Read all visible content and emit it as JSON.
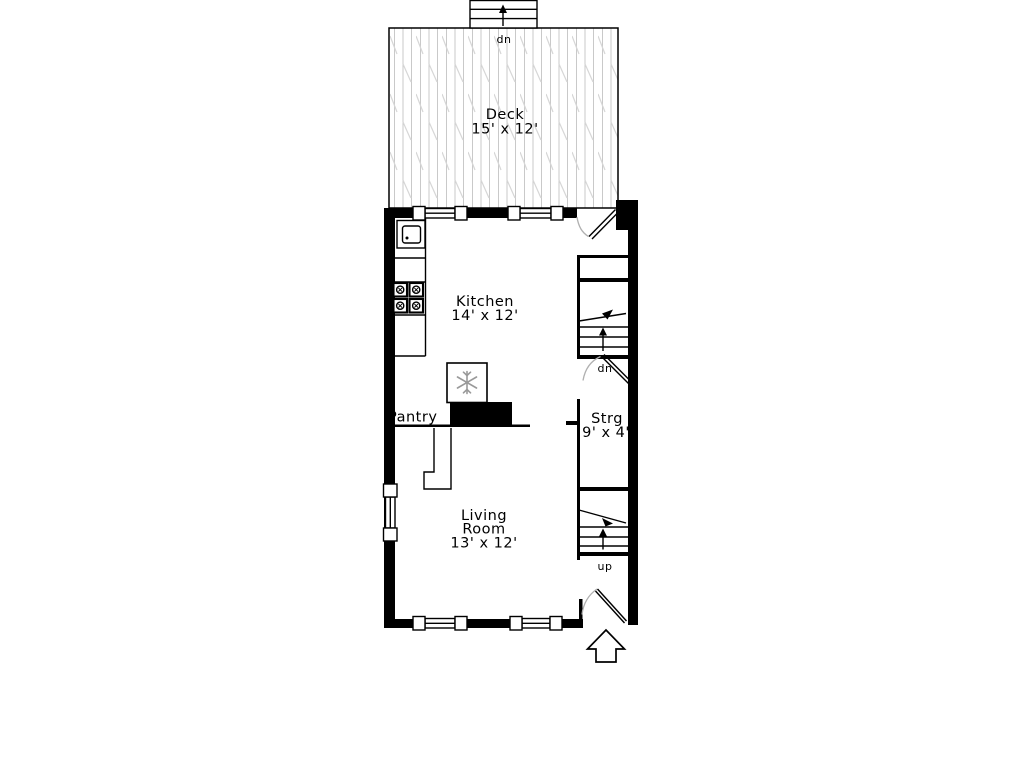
{
  "colors": {
    "wall": "#000000",
    "hatch": "#c9c9c9",
    "hatch2": "#d6d6d6",
    "arc": "#b0b0b0",
    "snowflake": "#999999",
    "bg": "#ffffff"
  },
  "rooms": {
    "deck": {
      "name": "Deck",
      "dims": "15' x 12'"
    },
    "kitchen": {
      "name": "Kitchen",
      "dims": "14' x 12'"
    },
    "pantry": {
      "name": "Pantry"
    },
    "storage": {
      "name": "Strg",
      "dims": "9' x 4'"
    },
    "living": {
      "name_line1": "Living",
      "name_line2": "Room",
      "dims": "13' x 12'"
    }
  },
  "stairs": {
    "deck_stairs_label": "dn",
    "basement_stairs_label": "dn",
    "upper_stairs_label": "up"
  }
}
